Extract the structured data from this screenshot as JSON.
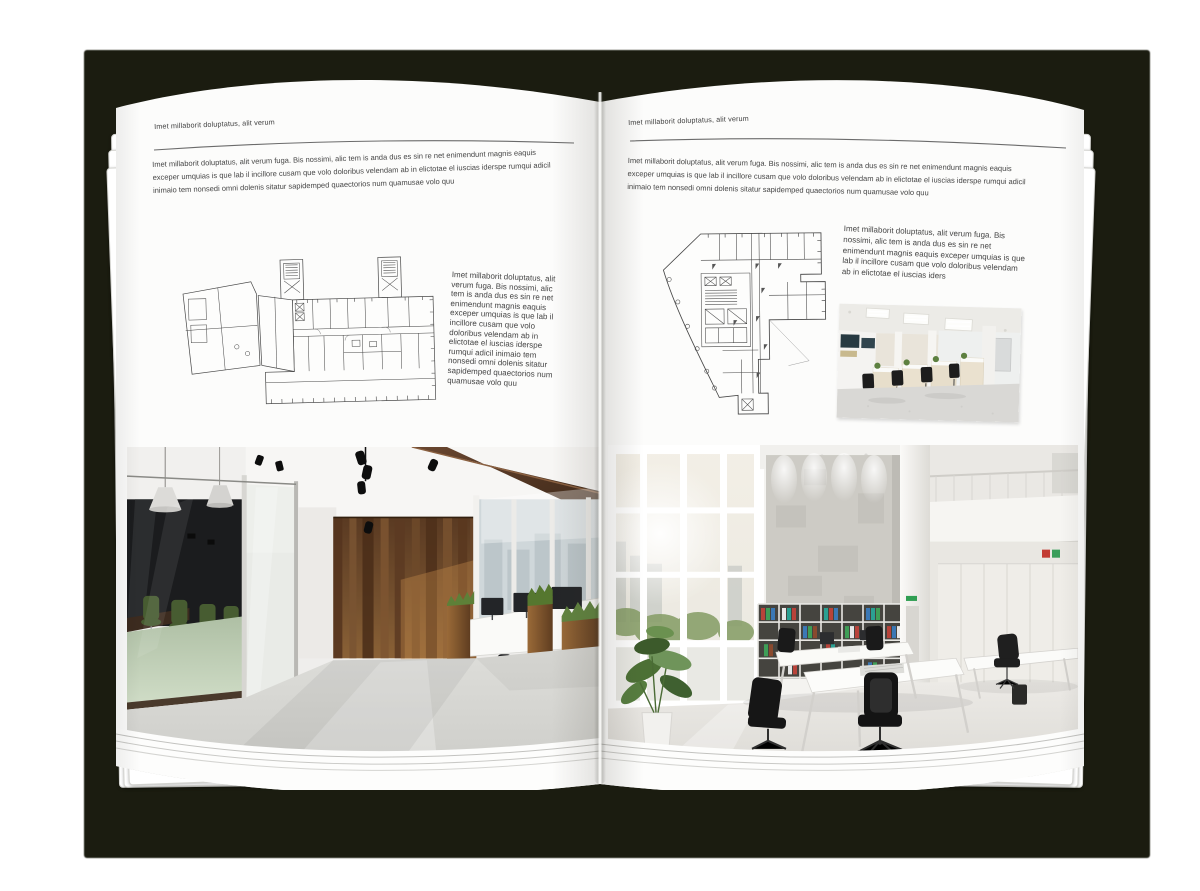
{
  "document": {
    "type": "open-brochure-mockup",
    "backdrop_color": "#1b1c10",
    "page_color": "#fcfcfb",
    "text_color": "#3e3e3e",
    "rule_color": "#6b6b6b"
  },
  "left_page": {
    "header": "Imet millaborit doluptatus, alit verum",
    "intro": "Imet millaborit doluptatus, alit verum fuga. Bis nossimi, alic tem is anda dus es sin re net enimendunt magnis eaquis exceper umquias is que lab il incillore cusam que volo doloribus velendam ab in elictotae el iuscias iderspe rumqui adicil inimaio tem nonsedi omni dolenis sitatur sapidemped quaectorios num quamusae volo quu",
    "side_text": "Imet millaborit doluptatus, alit verum fuga. Bis nossimi, alic tem is anda dus es sin re net enimendunt magnis eaquis exceper umquias is que lab il incillore cusam que volo doloribus velendam ab in elictotae el iuscias iderspe rumqui adicil inimaio tem nonsedi omni dolenis sitatur sapidemped quaectorios num quamusae volo quu",
    "floor_plan_icon": "floor-plan-wide-building",
    "photo_icon": "office-interior-dark-wood-photo"
  },
  "right_page": {
    "header": "Imet millaborit doluptatus, alit verum",
    "intro": "Imet millaborit doluptatus, alit verum fuga. Bis nossimi, alic tem is anda dus es sin re net enimendunt magnis eaquis exceper umquias is que lab il incillore cusam que volo doloribus velendam ab in elictotae el iuscias iderspe rumqui adicil inimaio tem nonsedi omni dolenis sitatur sapidemped quaectorios num quamusae volo quu",
    "side_text": "Imet millaborit doluptatus, alit verum fuga. Bis nossimi, alic tem is anda dus es sin re net enimendunt magnis eaquis exceper umquias is que lab il incillore cusam que volo doloribus velendam ab in elictotae el iuscias iders",
    "floor_plan_icon": "floor-plan-irregular-building",
    "small_photo_icon": "office-workstations-photo",
    "photo_icon": "office-interior-bright-loft-photo"
  }
}
